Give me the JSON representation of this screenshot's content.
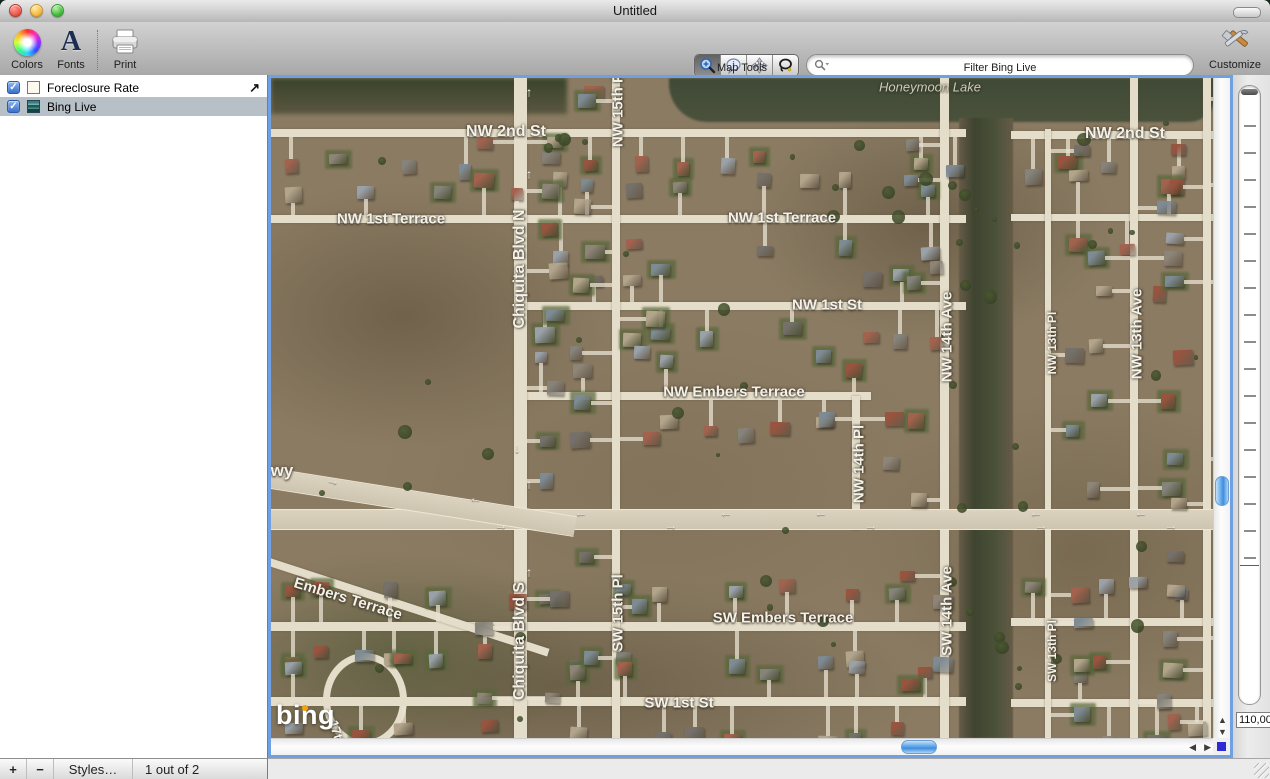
{
  "window": {
    "title": "Untitled"
  },
  "toolbar": {
    "colors_label": "Colors",
    "fonts_label": "Fonts",
    "print_label": "Print",
    "map_tools_label": "Map Tools",
    "filter_label": "Filter Bing Live",
    "customize_label": "Customize",
    "map_tools": [
      "zoom-tool",
      "info-tool",
      "pan-tool",
      "lasso-tool"
    ]
  },
  "sidebar": {
    "layers": [
      {
        "label": "Foreclosure Rate",
        "checked": true,
        "selected": false
      },
      {
        "label": "Bing Live",
        "checked": true,
        "selected": true
      }
    ],
    "bottom": {
      "add_label": "+",
      "remove_label": "−",
      "styles_label": "Styles…",
      "count_label": "1 out of 2"
    }
  },
  "map": {
    "attribution": "bing",
    "scale_value": "110,000",
    "check_glyph": "✓",
    "detail_arrow_glyph": "↗",
    "scroll_glyphs": {
      "up": "▲",
      "down": "▼",
      "left": "◀",
      "right": "▶"
    },
    "labels": [
      {
        "text": "Honeymoon Lake",
        "x": 659,
        "y": 9,
        "rot": 0,
        "size": 13,
        "cls": "water"
      },
      {
        "text": "NW 2nd St",
        "x": 235,
        "y": 54,
        "rot": 0,
        "size": 16
      },
      {
        "text": "NW 2nd St",
        "x": 854,
        "y": 56,
        "rot": 0,
        "size": 16
      },
      {
        "text": "NW 1st Terrace",
        "x": 120,
        "y": 141,
        "rot": 0,
        "size": 15
      },
      {
        "text": "NW 1st Terrace",
        "x": 511,
        "y": 140,
        "rot": 0,
        "size": 15
      },
      {
        "text": "NW 1st St",
        "x": 556,
        "y": 227,
        "rot": 0,
        "size": 15
      },
      {
        "text": "NW Embers Terrace",
        "x": 463,
        "y": 314,
        "rot": 0,
        "size": 15
      },
      {
        "text": "SW Embers Terrace",
        "x": 512,
        "y": 540,
        "rot": 0,
        "size": 15
      },
      {
        "text": "SW 1st St",
        "x": 408,
        "y": 625,
        "rot": 0,
        "size": 15
      },
      {
        "text": "wy",
        "x": 11,
        "y": 393,
        "rot": 0,
        "size": 17
      },
      {
        "text": "Embers Terrace",
        "x": 77,
        "y": 521,
        "rot": 17,
        "size": 15
      },
      {
        "text": "17th Ave",
        "x": 70,
        "y": 668,
        "rot": 73,
        "size": 13
      },
      {
        "text": "NW 15th Pl",
        "x": 347,
        "y": 30,
        "rot": -90,
        "size": 15
      },
      {
        "text": "Chiquita Blvd N",
        "x": 249,
        "y": 191,
        "rot": -90,
        "size": 16
      },
      {
        "text": "Chiquita Blvd S",
        "x": 249,
        "y": 563,
        "rot": -90,
        "size": 16
      },
      {
        "text": "SW 15th Pl",
        "x": 347,
        "y": 535,
        "rot": -90,
        "size": 15
      },
      {
        "text": "NW 14th Pl",
        "x": 588,
        "y": 386,
        "rot": -90,
        "size": 15
      },
      {
        "text": "NW 14th Ave",
        "x": 676,
        "y": 259,
        "rot": -90,
        "size": 15
      },
      {
        "text": "SW 14th Ave",
        "x": 676,
        "y": 533,
        "rot": -90,
        "size": 15
      },
      {
        "text": "NW 13th Pl",
        "x": 781,
        "y": 265,
        "rot": -90,
        "size": 12
      },
      {
        "text": "SW 13th Pl",
        "x": 781,
        "y": 573,
        "rot": -90,
        "size": 12
      },
      {
        "text": "NW 13th Ave",
        "x": 866,
        "y": 256,
        "rot": -90,
        "size": 15
      }
    ],
    "arrows": [
      {
        "g": "↑",
        "x": 258,
        "y": 14
      },
      {
        "g": "↑",
        "x": 258,
        "y": 96
      },
      {
        "g": "↓",
        "x": 246,
        "y": 370
      },
      {
        "g": "↑",
        "x": 258,
        "y": 406
      },
      {
        "g": "↑",
        "x": 258,
        "y": 494
      },
      {
        "g": "→",
        "x": 62,
        "y": 402,
        "rot": 9
      },
      {
        "g": "←",
        "x": 205,
        "y": 420,
        "rot": 9
      },
      {
        "g": "←",
        "x": 310,
        "y": 434
      },
      {
        "g": "←",
        "x": 455,
        "y": 434
      },
      {
        "g": "←",
        "x": 550,
        "y": 434
      },
      {
        "g": "←",
        "x": 765,
        "y": 434
      },
      {
        "g": "←",
        "x": 870,
        "y": 434
      },
      {
        "g": "→",
        "x": 230,
        "y": 447
      },
      {
        "g": "→",
        "x": 400,
        "y": 447
      },
      {
        "g": "→",
        "x": 600,
        "y": 447
      },
      {
        "g": "→",
        "x": 770,
        "y": 447
      },
      {
        "g": "→",
        "x": 900,
        "y": 447
      }
    ],
    "roads": {
      "horizontal": [
        {
          "y": 51,
          "x1": 0,
          "x2": 695,
          "h": 8
        },
        {
          "y": 53,
          "x1": 740,
          "x2": 944,
          "h": 8
        },
        {
          "y": 137,
          "x1": 0,
          "x2": 695,
          "h": 8
        },
        {
          "y": 136,
          "x1": 740,
          "x2": 944,
          "h": 7
        },
        {
          "y": 224,
          "x1": 250,
          "x2": 695,
          "h": 8
        },
        {
          "y": 314,
          "x1": 250,
          "x2": 600,
          "h": 8
        },
        {
          "y": 544,
          "x1": 0,
          "x2": 695,
          "h": 9
        },
        {
          "y": 540,
          "x1": 740,
          "x2": 944,
          "h": 8
        },
        {
          "y": 619,
          "x1": 0,
          "x2": 695,
          "h": 9
        },
        {
          "y": 621,
          "x1": 740,
          "x2": 944,
          "h": 8
        }
      ],
      "vertical": [
        {
          "x": 243,
          "y1": 0,
          "y2": 662,
          "w": 13
        },
        {
          "x": 341,
          "y1": 0,
          "y2": 662,
          "w": 8
        },
        {
          "x": 581,
          "y1": 318,
          "y2": 452,
          "w": 8
        },
        {
          "x": 669,
          "y1": 0,
          "y2": 662,
          "w": 9
        },
        {
          "x": 774,
          "y1": 51,
          "y2": 662,
          "w": 6
        },
        {
          "x": 859,
          "y1": 0,
          "y2": 662,
          "w": 8
        },
        {
          "x": 932,
          "y1": 0,
          "y2": 662,
          "w": 8
        }
      ],
      "highway_main": {
        "x1": 0,
        "x2": 944,
        "y": 431,
        "h": 19
      },
      "highway_diag": {
        "x": -12,
        "y": 388,
        "len": 320,
        "h": 19,
        "rot": 9
      },
      "diag_sw": {
        "x": -8,
        "y": 478,
        "len": 300,
        "h": 8,
        "rot": 18
      }
    }
  },
  "colors": {
    "focus_ring": "#6fa0e3",
    "scroll_thumb": "#3f8ede",
    "corner_square": "#2e2ad8",
    "selected_row": "#b7bfc7",
    "road": "#e4ddc9",
    "terrain": "#8b7b63",
    "canal": "#3e4430",
    "bing_dot": "#f4a20c"
  }
}
